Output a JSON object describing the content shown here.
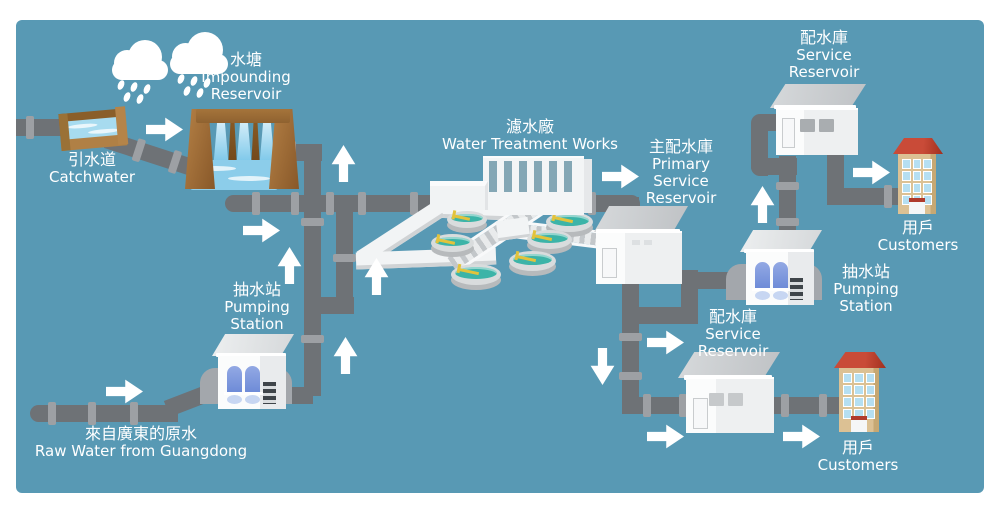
{
  "colors": {
    "background": "#5899B4",
    "frame": "#FFFFFF",
    "pipe": "#6E7276",
    "pipe_flange": "#9DA0A4",
    "arrow": "#FFFFFF",
    "text": "#FFFFFF",
    "tank_water": "#3CB4A8",
    "dam_water": "#6CC1E7",
    "pump_blue": "#7B98DD",
    "customer_building": "#DCC194",
    "roof_red": "#C0392B"
  },
  "icons": {
    "rain_cloud": "rain-cloud-icon",
    "flow_arrow": "flow-arrow-icon"
  },
  "nodes": {
    "impounding_reservoir": {
      "zh": "水塘",
      "en1": "Impounding",
      "en2": "Reservoir"
    },
    "catchwater": {
      "zh": "引水道",
      "en1": "Catchwater"
    },
    "water_treatment_works": {
      "zh": "濾水廠",
      "en1": "Water Treatment Works"
    },
    "primary_service_reservoir": {
      "zh": "主配水庫",
      "en1": "Primary",
      "en2": "Service",
      "en3": "Reservoir"
    },
    "service_reservoir_top": {
      "zh": "配水庫",
      "en1": "Service",
      "en2": "Reservoir"
    },
    "customers_top": {
      "zh": "用戶",
      "en1": "Customers"
    },
    "pumping_station_right": {
      "zh": "抽水站",
      "en1": "Pumping",
      "en2": "Station"
    },
    "service_reservoir_bottom": {
      "zh": "配水庫",
      "en1": "Service",
      "en2": "Reservoir"
    },
    "customers_bottom": {
      "zh": "用戶",
      "en1": "Customers"
    },
    "pumping_station_left": {
      "zh": "抽水站",
      "en1": "Pumping",
      "en2": "Station"
    },
    "raw_water_guangdong": {
      "zh": "來自廣東的原水",
      "en1": "Raw Water from Guangdong"
    }
  }
}
